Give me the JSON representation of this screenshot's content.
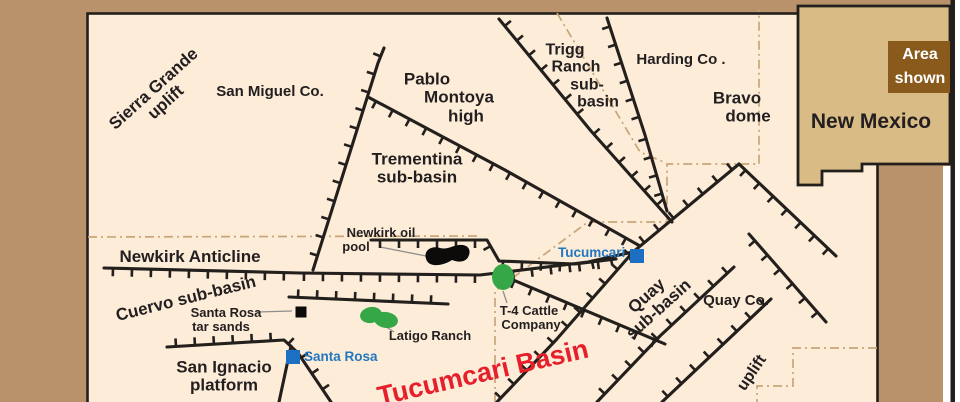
{
  "figure": {
    "canvas_w": 960,
    "canvas_h": 402,
    "colors": {
      "background": "#b9926b",
      "map_fill": "#fcecd8",
      "line": "#231f1c",
      "county_line": "#c8a578",
      "label": "#231f20",
      "city": "#2277c0",
      "city_square": "#1d6fc3",
      "basin_title": "#e61f2b",
      "green": "#36a747",
      "black_feature": "#0d0b09",
      "leader": "#8f8f8f",
      "white": "#ffffff"
    }
  },
  "inset": {
    "state_label": "New Mexico",
    "area_line1": "Area",
    "area_line2": "shown",
    "state_fill": "#d9bc85",
    "box_fill": "#8a5a1d",
    "state_path": "M798,6 L950,6 L950,164 L862,164 L862,171 L822,171 L822,185 L798,185 Z",
    "area_box": {
      "x": 888,
      "y": 41,
      "w": 62,
      "h": 52
    }
  },
  "map": {
    "basin_title": "Tucumcari Basin",
    "labels": [
      {
        "name": "sierra-grande-uplift",
        "lines": [
          "Sierra Grande",
          "uplift"
        ],
        "x": 160,
        "y": 96,
        "rot": -42,
        "size": 17
      },
      {
        "name": "san-miguel-county",
        "lines": [
          "San Miguel Co."
        ],
        "x": 270,
        "y": 92,
        "size": 15
      },
      {
        "name": "pablo-montoya-high",
        "lines": [
          "Pablo",
          "Montoya",
          "high"
        ],
        "dx": [
          -25,
          7,
          14
        ],
        "x": 452,
        "y": 98,
        "size": 17
      },
      {
        "name": "trigg-ranch-sub-basin",
        "lines": [
          "Trigg",
          "Ranch",
          "sub-",
          "basin"
        ],
        "dx": [
          -16,
          -5,
          6,
          17
        ],
        "x": 581,
        "y": 76,
        "size": 16
      },
      {
        "name": "harding-county",
        "lines": [
          "Harding Co ."
        ],
        "x": 681,
        "y": 60,
        "size": 15
      },
      {
        "name": "bravo-dome",
        "lines": [
          "Bravo",
          "dome"
        ],
        "dx": [
          -5,
          6
        ],
        "x": 742,
        "y": 108,
        "size": 17
      },
      {
        "name": "trementina-sub-basin",
        "lines": [
          "Trementina",
          "sub-basin"
        ],
        "x": 417,
        "y": 169,
        "size": 17
      },
      {
        "name": "newkirk-oil-pool",
        "lines": [
          "Newkirk oil",
          "pool"
        ],
        "dx": [
          0,
          -25
        ],
        "x": 381,
        "y": 240,
        "size": 13
      },
      {
        "name": "newkirk-anticline",
        "lines": [
          "Newkirk Anticline"
        ],
        "x": 190,
        "y": 257,
        "size": 17
      },
      {
        "name": "cuervo-sub-basin",
        "lines": [
          "Cuervo  sub-basin"
        ],
        "x": 186,
        "y": 299,
        "rot": -14,
        "size": 17
      },
      {
        "name": "santa-rosa-tar-sands",
        "lines": [
          "Santa Rosa",
          "tar sands"
        ],
        "dx": [
          0,
          -5
        ],
        "x": 226,
        "y": 320,
        "size": 13
      },
      {
        "name": "latigo-ranch",
        "lines": [
          "Latigo Ranch"
        ],
        "x": 430,
        "y": 336,
        "size": 13
      },
      {
        "name": "san-ignacio-platform",
        "lines": [
          "San Ignacio",
          "platform"
        ],
        "x": 224,
        "y": 377,
        "size": 17
      },
      {
        "name": "t4-cattle-company",
        "lines": [
          "T-4 Cattle",
          "Company"
        ],
        "dx": [
          -2,
          0
        ],
        "x": 531,
        "y": 318,
        "size": 13
      },
      {
        "name": "quay-sub-basin",
        "lines": [
          "Quay",
          "sub-basin"
        ],
        "x": 653,
        "y": 303,
        "rot": -42,
        "size": 17
      },
      {
        "name": "quay-county",
        "lines": [
          "Quay Co."
        ],
        "x": 736,
        "y": 301,
        "size": 15
      },
      {
        "name": "uplift",
        "lines": [
          "uplift"
        ],
        "x": 752,
        "y": 373,
        "rot": -56,
        "size": 16
      }
    ],
    "cities": [
      {
        "label": "Tucumcari",
        "x": 637,
        "y": 256,
        "label_x": 558,
        "label_y": 246
      },
      {
        "label": "Santa Rosa",
        "x": 293,
        "y": 357,
        "label_x": 304,
        "label_y": 350
      }
    ],
    "point_markers": [
      {
        "name": "santa-rosa-tar-sands-marker",
        "x": 301,
        "y": 312,
        "size": 11
      }
    ],
    "oil_pool_path": "M427,261 C422,252 430,245 440,248 C447,250 451,246 459,245 C468,244 471,250 469,255 C467,262 459,263 452,260 C445,265 431,268 427,261 Z",
    "green_areas": [
      {
        "name": "t4-cattle-area",
        "cx": 503,
        "cy": 277,
        "rx": 11,
        "ry": 13,
        "rot": 0
      },
      {
        "name": "latigo-ranch-area-west",
        "cx": 371,
        "cy": 315,
        "rx": 11,
        "ry": 8,
        "rot": -10
      },
      {
        "name": "latigo-ranch-area-east",
        "cx": 386,
        "cy": 320,
        "rx": 12,
        "ry": 8,
        "rot": 8
      }
    ],
    "leader_lines": [
      {
        "name": "newkirk-oil-pool-leader",
        "x1": 380,
        "y1": 247,
        "x2": 426,
        "y2": 256
      },
      {
        "name": "tar-sands-leader",
        "x1": 257,
        "y1": 312,
        "x2": 292,
        "y2": 311
      },
      {
        "name": "latigo-ranch-leader",
        "x1": 379,
        "y1": 322,
        "x2": 394,
        "y2": 332
      },
      {
        "name": "t4-cattle-leader",
        "x1": 503,
        "y1": 291,
        "x2": 507,
        "y2": 303
      }
    ],
    "county_boundaries": [
      {
        "name": "county-line-west",
        "points": [
          [
            88,
            237
          ],
          [
            480,
            236
          ]
        ]
      },
      {
        "name": "county-line-central",
        "points": [
          [
            495,
            402
          ],
          [
            495,
            291
          ],
          [
            588,
            222
          ],
          [
            667,
            222
          ],
          [
            667,
            164
          ],
          [
            759,
            164
          ],
          [
            759,
            10
          ]
        ]
      },
      {
        "name": "county-line-southeast",
        "points": [
          [
            877,
            348
          ],
          [
            793,
            348
          ],
          [
            793,
            386
          ],
          [
            757,
            386
          ],
          [
            757,
            402
          ]
        ]
      },
      {
        "name": "county-line-northeast",
        "points": [
          [
            557,
            13
          ],
          [
            640,
            152
          ],
          [
            666,
            163
          ]
        ]
      }
    ],
    "faults": [
      {
        "name": "trementina-west-fault",
        "points": [
          [
            384,
            48
          ],
          [
            378,
            63
          ],
          [
            313,
            270
          ]
        ],
        "tick_side": "A"
      },
      {
        "name": "pablo-montoya-south-fault",
        "points": [
          [
            368,
            97
          ],
          [
            505,
            170
          ],
          [
            640,
            246
          ]
        ],
        "tick_side": "A"
      },
      {
        "name": "trigg-west-fault",
        "points": [
          [
            499,
            19
          ],
          [
            591,
            131
          ],
          [
            672,
            222
          ]
        ],
        "tick_side": "B"
      },
      {
        "name": "trigg-east-fault",
        "points": [
          [
            607,
            18
          ],
          [
            645,
            135
          ],
          [
            667,
            211
          ]
        ],
        "tick_side": "A"
      },
      {
        "name": "newkirk-anticline-fault",
        "points": [
          [
            104,
            268
          ],
          [
            300,
            273
          ],
          [
            480,
            275
          ],
          [
            588,
            262
          ],
          [
            637,
            251
          ]
        ],
        "tick_side": "A"
      },
      {
        "name": "newkirk-north-fault",
        "points": [
          [
            371,
            240
          ],
          [
            487,
            240
          ],
          [
            499,
            261
          ],
          [
            575,
            264
          ],
          [
            616,
            259
          ]
        ],
        "tick_side": "A"
      },
      {
        "name": "cuervo-south-fault",
        "points": [
          [
            289,
            297
          ],
          [
            448,
            304
          ]
        ],
        "tick_side": "B"
      },
      {
        "name": "t4-southeast-fault",
        "points": [
          [
            506,
            277
          ],
          [
            665,
            344
          ]
        ],
        "tick_side": "A"
      },
      {
        "name": "quay-main-fault",
        "points": [
          [
            739,
            164
          ],
          [
            633,
            252
          ],
          [
            556,
            340
          ],
          [
            497,
            402
          ]
        ],
        "tick_side": "A"
      },
      {
        "name": "quay-apex-east-fault",
        "points": [
          [
            739,
            164
          ],
          [
            836,
            256
          ]
        ],
        "tick_side": "A"
      },
      {
        "name": "quay-parallel-fault",
        "points": [
          [
            749,
            234
          ],
          [
            826,
            322
          ]
        ],
        "tick_side": "A"
      },
      {
        "name": "quay-co-west-fault",
        "points": [
          [
            734,
            267
          ],
          [
            660,
            336
          ],
          [
            597,
            402
          ]
        ],
        "tick_side": "A"
      },
      {
        "name": "quay-co-east-fault",
        "points": [
          [
            771,
            299
          ],
          [
            662,
            402
          ]
        ],
        "tick_side": "A"
      },
      {
        "name": "san-ignacio-fault",
        "points": [
          [
            167,
            347
          ],
          [
            284,
            340
          ],
          [
            298,
            353
          ],
          [
            331,
            402
          ]
        ],
        "tick_side": "B"
      },
      {
        "name": "san-ignacio-branch-fault",
        "points": [
          [
            291,
            346
          ],
          [
            279,
            402
          ]
        ],
        "tick_side": "none"
      }
    ]
  }
}
